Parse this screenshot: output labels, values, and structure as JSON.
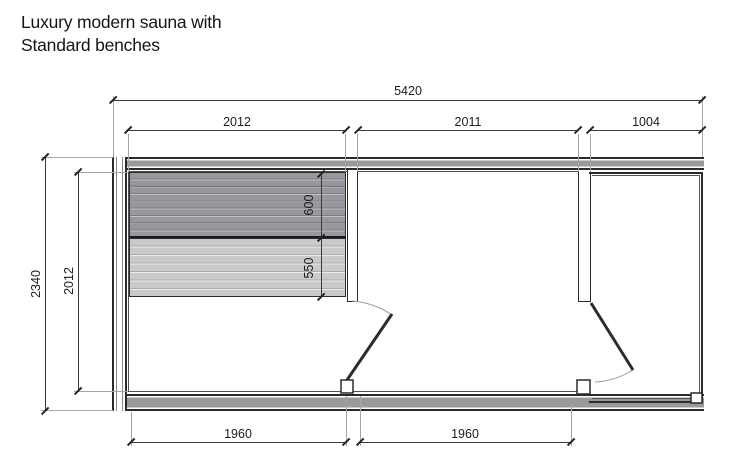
{
  "title": {
    "line1": "Luxury modern sauna with",
    "line2": "Standard benches"
  },
  "dimensions": {
    "overall_width": "5420",
    "segment_left": "2012",
    "segment_middle": "2011",
    "segment_right": "1004",
    "overall_depth": "2340",
    "interior_depth": "2012",
    "bench_upper_depth": "600",
    "bench_lower_depth": "550",
    "bottom_left": "1960",
    "bottom_right": "1960"
  },
  "colors": {
    "line": "#2b2b2b",
    "wall-fill": "#9a9a9a",
    "dim": "#3a3a3a",
    "ext": "#a6a6a6",
    "liner": "#4f4f4f"
  }
}
